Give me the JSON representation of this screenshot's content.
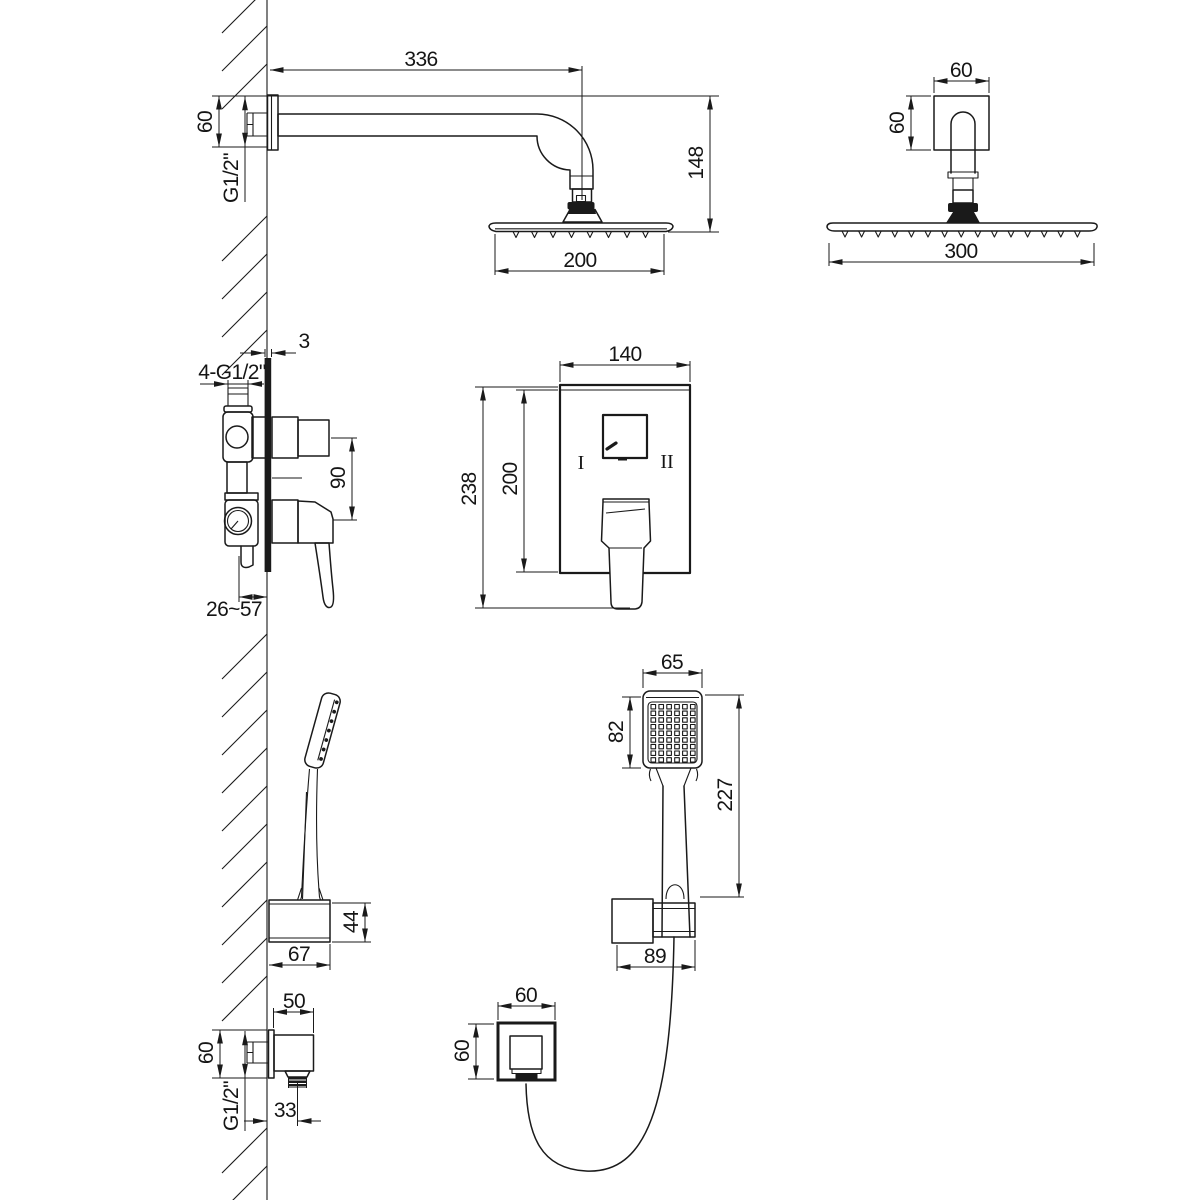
{
  "colors": {
    "background": "#ffffff",
    "line": "#1a1a1a"
  },
  "views": {
    "arm_side": {
      "dims": {
        "length": "336",
        "flange": "60",
        "thread": "G1/2\"",
        "height": "148",
        "head_width": "200"
      }
    },
    "arm_front": {
      "dims": {
        "flange_width": "60",
        "flange_height": "60",
        "head_width": "300"
      }
    },
    "mixer_side": {
      "dims": {
        "wall_plate": "3",
        "inlet_thread": "4-G1/2\"",
        "port_spacing": "90",
        "install_depth": "26~57"
      }
    },
    "trim_front": {
      "dims": {
        "width": "140",
        "total_height": "238",
        "plate_height": "200"
      },
      "labels": {
        "position_left": "I",
        "position_right": "II"
      }
    },
    "holder_side": {
      "dims": {
        "depth": "67",
        "height": "44"
      }
    },
    "handshower_front": {
      "dims": {
        "head_width": "65",
        "face_height": "82",
        "length": "227",
        "holder_width": "89"
      }
    },
    "outlet_front": {
      "dims": {
        "width": "60",
        "height": "60"
      }
    },
    "outlet_side": {
      "dims": {
        "depth": "50",
        "height": "60",
        "thread": "G1/2\"",
        "offset": "33"
      }
    }
  }
}
